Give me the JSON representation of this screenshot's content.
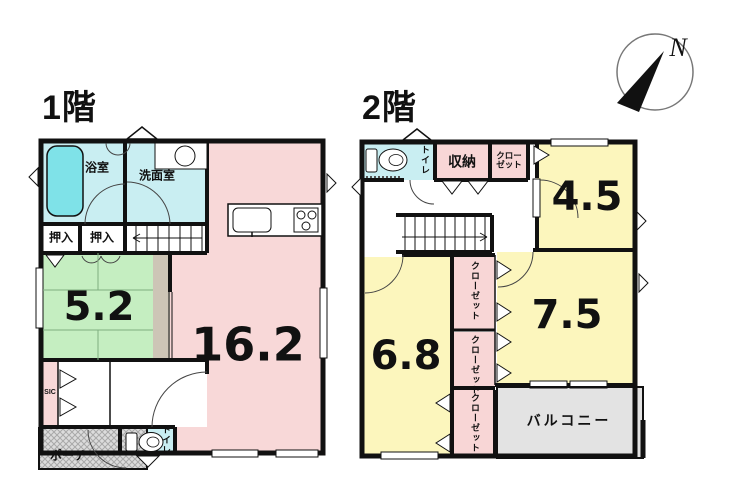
{
  "floor1": {
    "title": "1階",
    "rooms": {
      "bath": "浴室",
      "washroom": "洗面室",
      "oshiire1": "押入",
      "oshiire2": "押入",
      "tatami_size": "5.2",
      "ldk_size": "16.2",
      "sic": "SIC",
      "porch": "ポーチ",
      "toilet": "トイレ"
    }
  },
  "floor2": {
    "title": "2階",
    "rooms": {
      "toilet": "トイレ",
      "storage": "収納",
      "closet_top_line1": "クロー",
      "closet_top_line2": "ゼット",
      "room_45_size": "4.5",
      "room_68_size": "6.8",
      "room_75_size": "7.5",
      "closet_a": "クローゼット",
      "closet_b": "クローゼット",
      "closet_c": "クローゼット",
      "balcony": "バルコニー"
    }
  },
  "compass": {
    "north_label": "N"
  },
  "colors": {
    "wall": "#111111",
    "room_pink": "#f8d8d8",
    "room_cyan": "#c9eef2",
    "room_green": "#c5eec1",
    "room_yellow": "#fcf6bd",
    "closet_pink": "#f8d6d6",
    "beige_strip": "#cdc5b6",
    "balcony_gray": "#e3e3e3",
    "porch_gray": "#dcdcdc",
    "tub_cyan": "#7fe2e8"
  }
}
